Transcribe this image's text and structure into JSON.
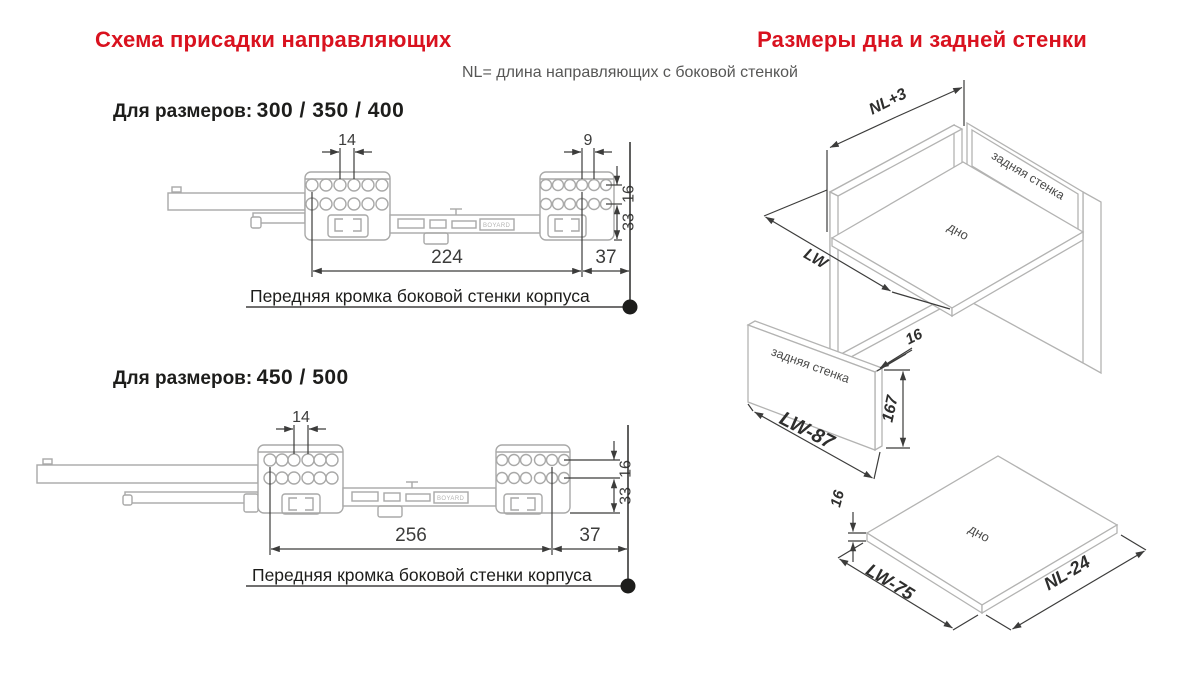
{
  "colors": {
    "accent_red": "#d9121f",
    "dimension_line": "#3c3c3b",
    "drawing_gray": "#a9a9a8",
    "text_dark": "#1d1d1b",
    "subtitle_gray": "#575756"
  },
  "headings": {
    "left": "Схема присадки направляющих",
    "right": "Размеры дна и задней стенки"
  },
  "subtitle": "NL= длина направляющих с боковой стенкой",
  "slide_300": {
    "title_label": "Для размеров:",
    "title_sizes": "300 / 350 / 400",
    "dim_hole_pitch": "14",
    "dim_hole_pitch_right": "9",
    "dim_row_gap": "16",
    "dim_bottom_offset": "33",
    "dim_length": "224",
    "dim_front_offset": "37",
    "edge_label": "Передняя кромка боковой стенки корпуса",
    "brand_mark": "BOYARD"
  },
  "slide_450": {
    "title_label": "Для размеров:",
    "title_sizes": "450 / 500",
    "dim_hole_pitch": "14",
    "dim_row_gap": "16",
    "dim_bottom_offset": "33",
    "dim_length": "256",
    "dim_front_offset": "37",
    "edge_label": "Передняя кромка боковой стенки корпуса",
    "brand_mark": "BOYARD"
  },
  "cabinet": {
    "dim_depth": "NL+3",
    "dim_width": "LW",
    "back_wall_label": "задняя стенка",
    "bottom_label": "дно"
  },
  "back_panel": {
    "label": "задняя стенка",
    "dim_width": "LW-87",
    "dim_height": "167",
    "dim_thickness": "16"
  },
  "bottom_panel": {
    "label": "дно",
    "dim_width": "LW-75",
    "dim_depth": "NL-24",
    "dim_thickness": "16"
  }
}
